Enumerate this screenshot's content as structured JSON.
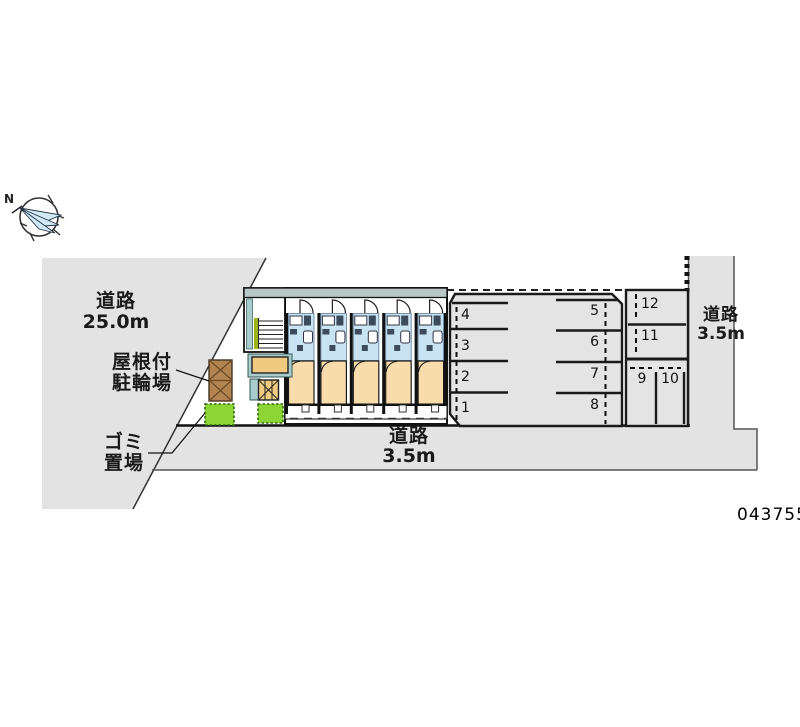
{
  "plan_id": "043755",
  "compass": {
    "label": "N"
  },
  "roads": {
    "left": {
      "name": "道路",
      "width": "25.0m"
    },
    "bottom": {
      "name": "道路",
      "width": "3.5m"
    },
    "right": {
      "name": "道路",
      "width": "3.5m"
    }
  },
  "annotations": {
    "bicycle_shed": {
      "line1": "屋根付",
      "line2": "駐輪場"
    },
    "garbage_area": {
      "line1": "ゴミ",
      "line2": "置場"
    }
  },
  "parking": {
    "column_a": [
      "4",
      "3",
      "2",
      "1"
    ],
    "column_b": [
      "5",
      "6",
      "7",
      "8"
    ],
    "block_c_upper": [
      "12",
      "11"
    ],
    "block_c_lower": [
      "9",
      "10"
    ]
  },
  "building": {
    "unit_count": "5"
  },
  "colors": {
    "road_gray": "#e3e3e3",
    "parking_gray": "#e4e4e4",
    "roof_band": "#b9c7c7",
    "unit_wet_area_blue": "#c9e3f3",
    "unit_room_tan": "#f9dcab",
    "porch_tan": "#eecb80",
    "utility_teal": "#a9cdcd",
    "grass_green": "#8dd435",
    "shed_brown": "#b28452",
    "stair_accent_green": "#9db31c",
    "compass_needle_blue": "#d2e9f6"
  }
}
